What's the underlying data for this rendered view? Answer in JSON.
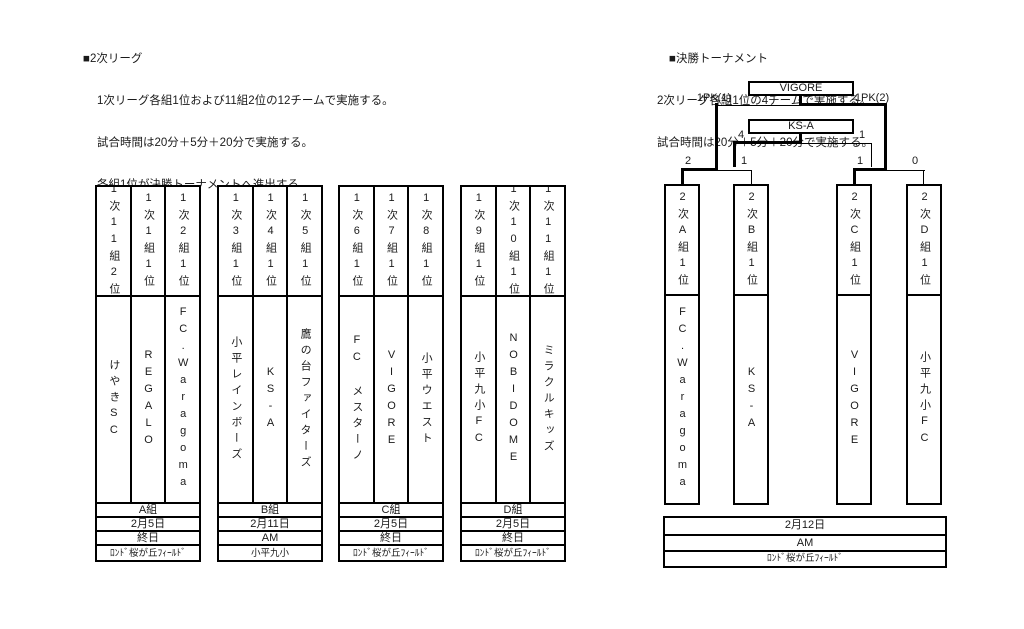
{
  "left_section": {
    "title": "■2次リーグ",
    "description_lines": [
      "1次リーグ各組1位および11組2位の12チームで実施する。",
      "試合時間は20分＋5分＋20分で実施する。",
      "各組1位が決勝トーナメントへ進出する"
    ],
    "groups": [
      {
        "name": "A組",
        "date": "2月5日",
        "time": "終日",
        "venue": "ﾛﾝﾄﾞ桜が丘ﾌｨｰﾙﾄﾞ",
        "slots": [
          {
            "seed": "1次11組2位",
            "team": "けやきSC"
          },
          {
            "seed": "1次1組1位",
            "team": "REGALO"
          },
          {
            "seed": "1次2組1位",
            "team": "FC.Waragoma"
          }
        ]
      },
      {
        "name": "B組",
        "date": "2月11日",
        "time": "AM",
        "venue": "小平九小",
        "slots": [
          {
            "seed": "1次3組1位",
            "team": "小平レインボーズ"
          },
          {
            "seed": "1次4組1位",
            "team": "KS-A"
          },
          {
            "seed": "1次5組1位",
            "team": "鷹の台ファイターズ"
          }
        ]
      },
      {
        "name": "C組",
        "date": "2月5日",
        "time": "終日",
        "venue": "ﾛﾝﾄﾞ桜が丘ﾌｨｰﾙﾄﾞ",
        "slots": [
          {
            "seed": "1次6組1位",
            "team": "FC メスターノ"
          },
          {
            "seed": "1次7組1位",
            "team": "VIGORE"
          },
          {
            "seed": "1次8組1位",
            "team": "小平ウエスト"
          }
        ]
      },
      {
        "name": "D組",
        "date": "2月5日",
        "time": "終日",
        "venue": "ﾛﾝﾄﾞ桜が丘ﾌｨｰﾙﾄﾞ",
        "slots": [
          {
            "seed": "1次9組1位",
            "team": "小平九小FC"
          },
          {
            "seed": "1次10組1位",
            "team": "NOBIDOME"
          },
          {
            "seed": "1次11組1位",
            "team": "ミラクルキッズ"
          }
        ]
      }
    ]
  },
  "right_section": {
    "title": "■決勝トーナメント",
    "description_lines": [
      "2次リーグ各組1位の4チームで実施する。",
      "試合時間は20分＋5分＋20分で実施する。"
    ],
    "bracket": {
      "champion": "VIGORE",
      "third_place_winner": "KS-A",
      "final": {
        "left_score": "1PK(1)",
        "right_score": "1PK(2)"
      },
      "third_place": {
        "left_score": "4",
        "right_score": "1"
      },
      "semifinal_1": {
        "left_score": "2",
        "right_score": "1"
      },
      "semifinal_2": {
        "left_score": "1",
        "right_score": "0"
      },
      "slots": [
        {
          "seed": "2次A組1位",
          "team": "FC.Waragoma"
        },
        {
          "seed": "2次B組1位",
          "team": "KS-A"
        },
        {
          "seed": "2次C組1位",
          "team": "VIGORE"
        },
        {
          "seed": "2次D組1位",
          "team": "小平九小FC"
        }
      ]
    },
    "schedule": {
      "date": "2月12日",
      "time": "AM",
      "venue": "ﾛﾝﾄﾞ桜が丘ﾌｨｰﾙﾄﾞ"
    }
  }
}
